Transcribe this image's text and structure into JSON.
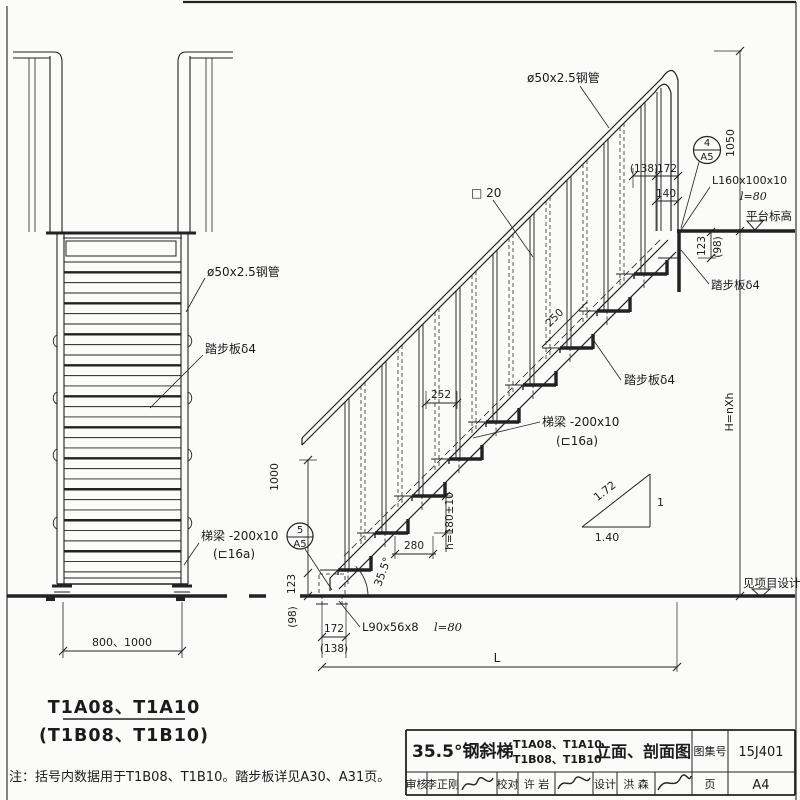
{
  "colors": {
    "ink": "#1e1e1e",
    "paper": "#fbfbfa"
  },
  "left_view": {
    "pipe_label": "ø50x2.5钢管",
    "tread_label": "踏步板δ4",
    "beam_label": "梯梁 -200x10",
    "beam_label2": "(⊏16a)",
    "width_dim": "800、1000",
    "title_line1": "T1A08、T1A10",
    "title_line2": "(T1B08、T1B10)"
  },
  "right_view": {
    "pipe_label": "ø50x2.5钢管",
    "baluster_label": "□ 20",
    "dim_138_top": "(138)",
    "dim_172_top": "172",
    "dim_140": "140",
    "dim_1050": "1050",
    "detail_top_no": "4",
    "detail_top_sheet": "A5",
    "angle_cleat_top": "L160x100x10",
    "angle_cleat_top_len": "l=80",
    "platform_level_label": "平台标高",
    "dim_123_top": "123",
    "dim_98_top": "(98)",
    "tread_label_top": "踏步板δ4",
    "dim_250": "250",
    "dim_252": "252",
    "tread_label": "踏步板δ4",
    "beam_label": "梯梁 -200x10",
    "beam_label2": "(⊏16a)",
    "slope_hyp": "1.72",
    "slope_rise": "1",
    "slope_run": "1.40",
    "dim_height": "H=nXh",
    "see_project_label": "见项目设计",
    "dim_1000": "1000",
    "dim_123_bot": "123",
    "dim_98_bot": "(98)",
    "dim_riser": "h=180±10",
    "dim_280": "280",
    "slope_angle": "35.5°",
    "detail_bot_no": "5",
    "detail_bot_sheet": "A5",
    "angle_cleat_bot": "L90x56x8",
    "angle_cleat_bot_len": "l=80",
    "dim_172_bot": "172",
    "dim_138_bot": "(138)",
    "dim_L": "L"
  },
  "note": "注：括号内数据用于T1B08、T1B10。踏步板详见A30、A31页。",
  "title_block": {
    "main_title": "35.5°钢斜梯",
    "models_line1": "T1A08、T1A10",
    "models_line2": "T1B08、T1B10",
    "drawing_type": "立面、剖面图",
    "atlas_label": "图集号",
    "atlas_number": "15J401",
    "review_label": "审核",
    "review_name": "李正刚",
    "proof_label": "校对",
    "proof_name": "许 岩",
    "design_label": "设计",
    "design_name": "洪 森",
    "page_label": "页",
    "page_number": "A4"
  }
}
